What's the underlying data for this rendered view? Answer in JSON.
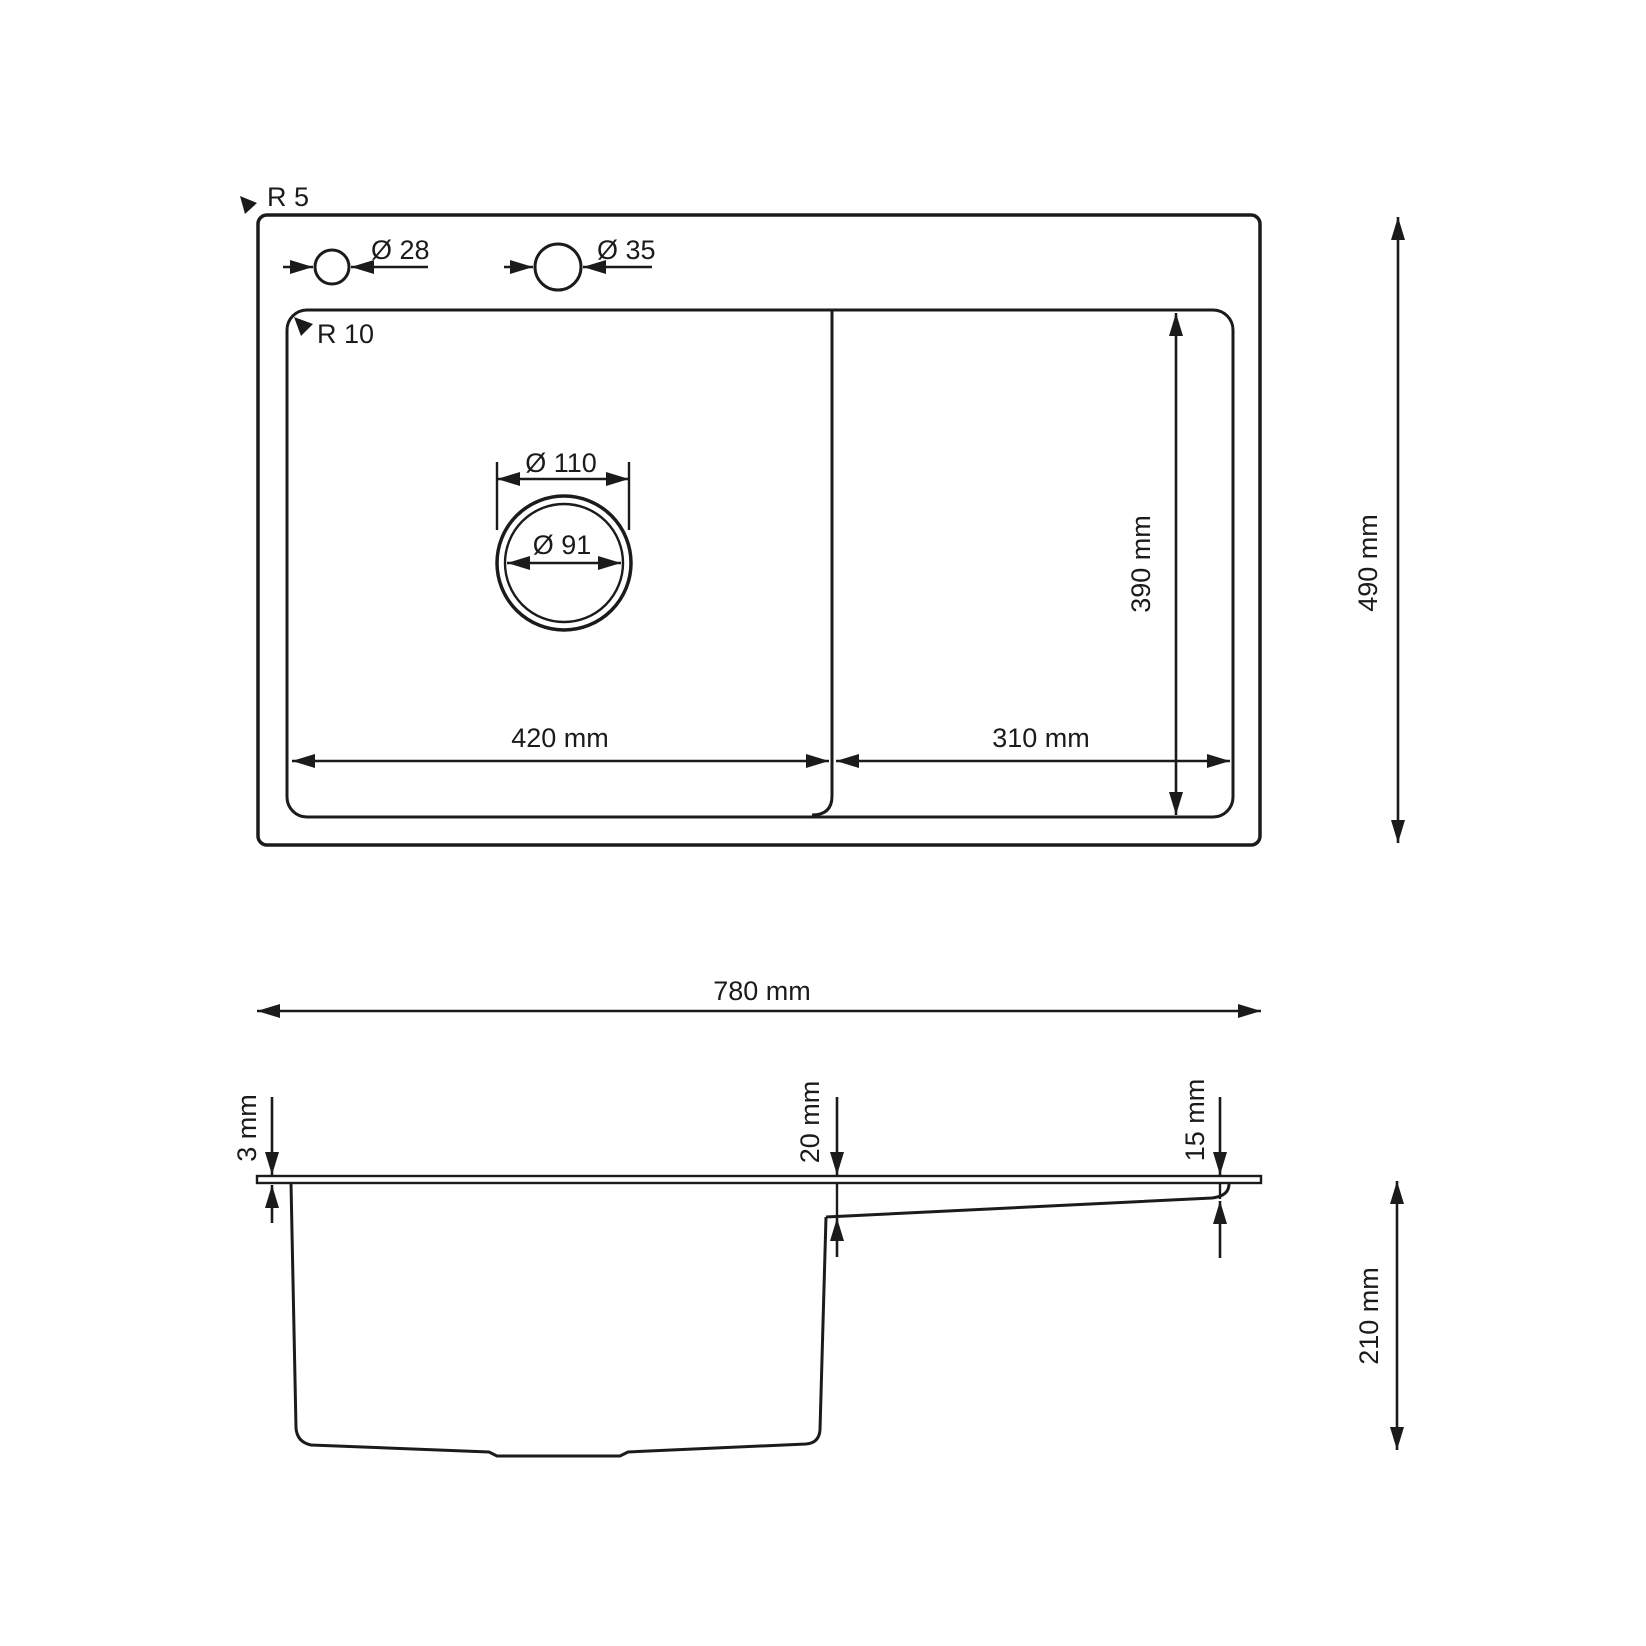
{
  "colors": {
    "line": "#1b1b1b",
    "background": "#ffffff"
  },
  "top_view": {
    "outer_radius": "R 5",
    "inner_radius": "R 10",
    "small_hole_diameter": "Ø 28",
    "large_hole_diameter": "Ø 35",
    "drain_flange_diameter": "Ø 110",
    "drain_hole_diameter": "Ø 91",
    "bowl_width": "420 mm",
    "drainboard_width": "310 mm",
    "bowl_depth": "390 mm",
    "overall_depth": "490 mm"
  },
  "side_view": {
    "overall_width": "780 mm",
    "rim_thickness": "3 mm",
    "drainboard_drop": "20 mm",
    "drainboard_edge_height": "15 mm",
    "bowl_height": "210 mm"
  }
}
